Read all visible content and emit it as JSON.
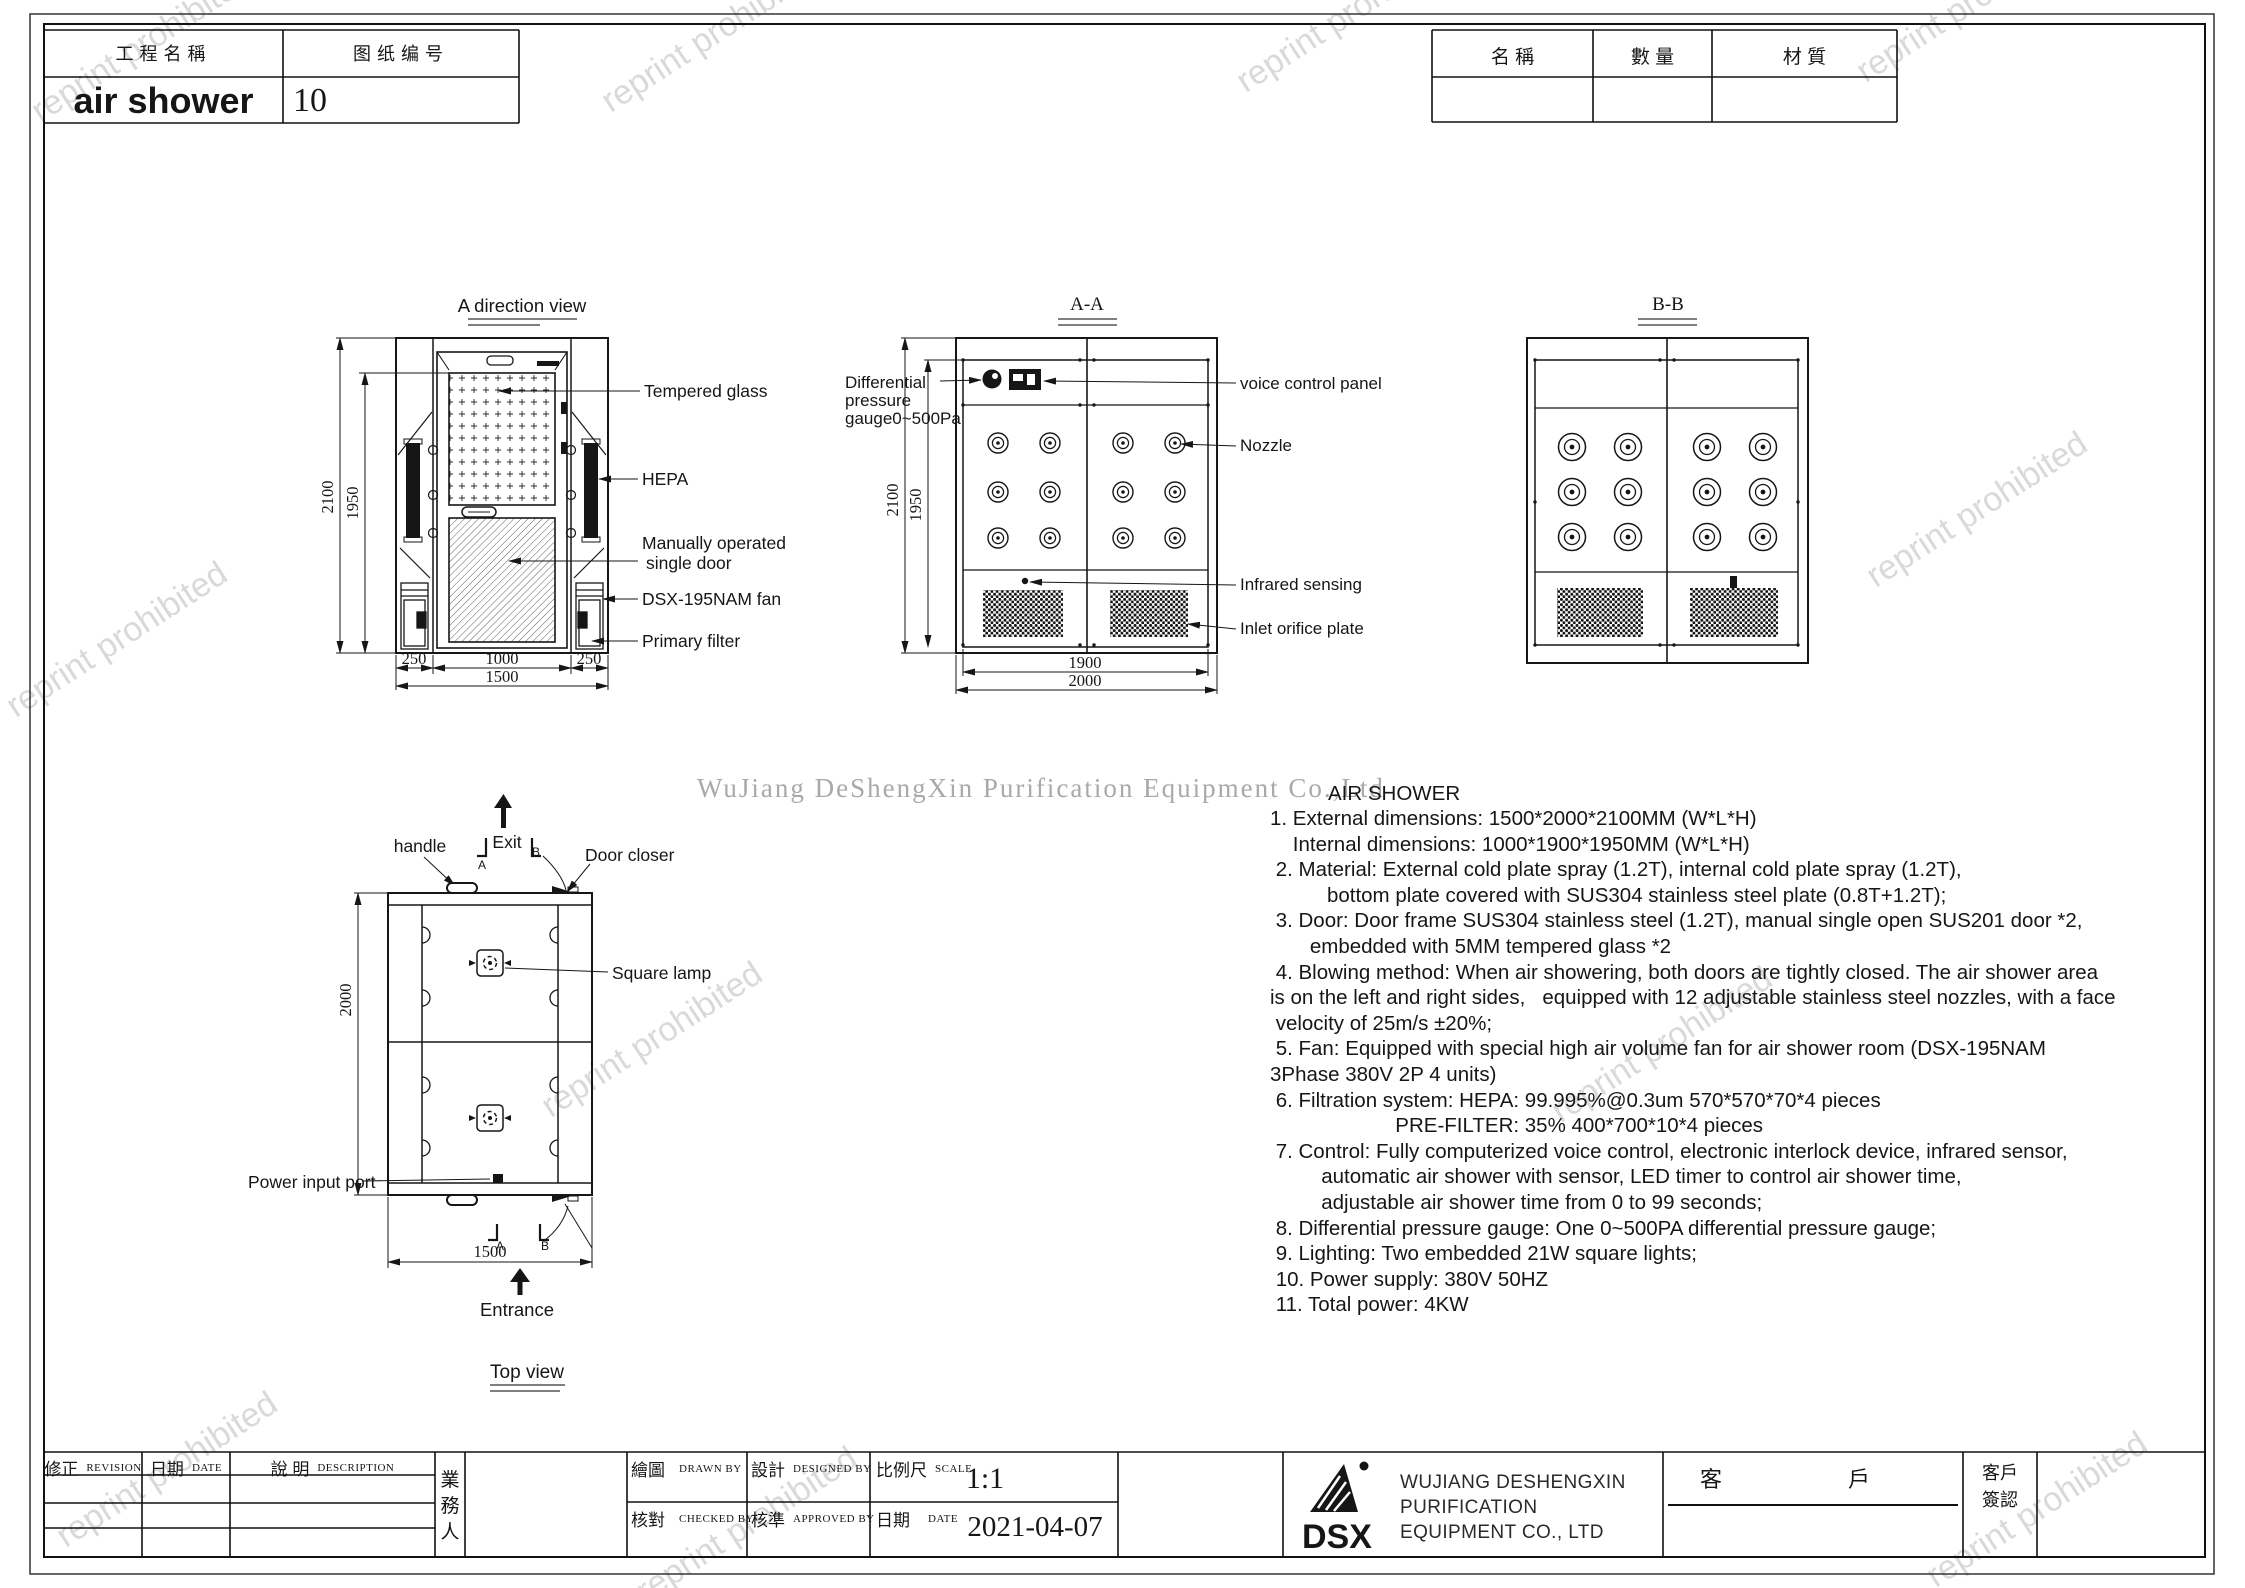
{
  "header": {
    "project_name_label": "工程名稱",
    "drawing_no_label": "图纸编号",
    "project_name": "air shower",
    "drawing_no": "10",
    "parts_table": {
      "name_label": "名  稱",
      "qty_label": "數  量",
      "material_label": "材  質"
    }
  },
  "views": {
    "front": {
      "title": "A direction view",
      "labels": {
        "tempered_glass": "Tempered glass",
        "hepa": "HEPA",
        "door_line1": "Manually operated",
        "door_line2": "single door",
        "fan": "DSX-195NAM fan",
        "primary_filter": "Primary filter"
      },
      "dims": {
        "h_total": "2100",
        "h_inner": "1950",
        "seg_left": "250",
        "seg_mid": "1000",
        "seg_right": "250",
        "w_total": "1500"
      }
    },
    "section_aa": {
      "title": "A-A",
      "labels": {
        "gauge_line1": "Differential",
        "gauge_line2": "pressure",
        "gauge_line3": "gauge0~500Pa",
        "voice": "voice control panel",
        "nozzle": "Nozzle",
        "infrared": "Infrared sensing",
        "inlet": "Inlet orifice plate"
      },
      "dims": {
        "h_total": "2100",
        "h_inner": "1950",
        "w_inner": "1900",
        "w_total": "2000"
      }
    },
    "section_bb": {
      "title": "B-B"
    },
    "top": {
      "title": "Top view",
      "labels": {
        "handle": "handle",
        "exit": "Exit",
        "door_closer": "Door closer",
        "square_lamp": "Square lamp",
        "power": "Power input port",
        "entrance": "Entrance",
        "mark_a": "A",
        "mark_b": "B"
      },
      "dims": {
        "depth": "2000",
        "width": "1500"
      }
    }
  },
  "specs": {
    "title": "AIR SHOWER",
    "lines": [
      "1. External dimensions: 1500*2000*2100MM (W*L*H)",
      "    Internal dimensions: 1000*1900*1950MM (W*L*H)",
      " 2. Material: External cold plate spray (1.2T), internal cold plate spray (1.2T),",
      "          bottom plate covered with SUS304 stainless steel plate (0.8T+1.2T);",
      " 3. Door: Door frame SUS304 stainless steel (1.2T), manual single open SUS201 door *2,",
      "       embedded with 5MM tempered glass *2",
      " 4. Blowing method: When air showering, both doors are tightly closed. The air shower area",
      "is on the left and right sides,   equipped with 12 adjustable stainless steel nozzles, with a face",
      " velocity of 25m/s ±20%;",
      " 5. Fan: Equipped with special high air volume fan for air shower room (DSX-195NAM",
      "3Phase 380V 2P 4 units)",
      " 6. Filtration system: HEPA: 99.995%@0.3um 570*570*70*4 pieces",
      "                      PRE-FILTER: 35% 400*700*10*4 pieces",
      " 7. Control: Fully computerized voice control, electronic interlock device, infrared sensor,",
      "         automatic air shower with sensor, LED timer to control air shower time,",
      "         adjustable air shower time from 0 to 99 seconds;",
      " 8. Differential pressure gauge: One 0~500PA differential pressure gauge;",
      " 9. Lighting: Two embedded 21W square lights;",
      " 10. Power supply: 380V 50HZ",
      " 11. Total power: 4KW"
    ]
  },
  "watermark": {
    "diagonal": "reprint prohibited",
    "company": "WuJiang DeShengXin  Purification  Equipment  Co.,Ltd"
  },
  "title_block": {
    "revision_cn": "修正",
    "revision_en": "REVISION",
    "date_cn": "日期",
    "date_en": "DATE",
    "desc_cn": "說  明",
    "desc_en": "DESCRIPTION",
    "sales_person": "業\n務\n人",
    "drawn_cn": "繪圖",
    "drawn_en": "DRAWN BY",
    "designed_cn": "設計",
    "designed_en": "DESIGNED BY",
    "scale_cn": "比例尺",
    "scale_en": "SCALE",
    "scale_value": "1:1",
    "checked_cn": "核對",
    "checked_en": "CHECKED BY",
    "approved_cn": "核準",
    "approved_en": "APPROVED BY",
    "date2_cn": "日期",
    "date2_en": "DATE",
    "date_value": "2021-04-07",
    "logo_text": "DSX",
    "company_line1": "WUJIANG DESHENGXIN",
    "company_line2": "PURIFICATION",
    "company_line3": "EQUIPMENT CO., LTD",
    "customer_char1": "客",
    "customer_char2": "戶",
    "customer_sign": "客戶\n簽認"
  }
}
